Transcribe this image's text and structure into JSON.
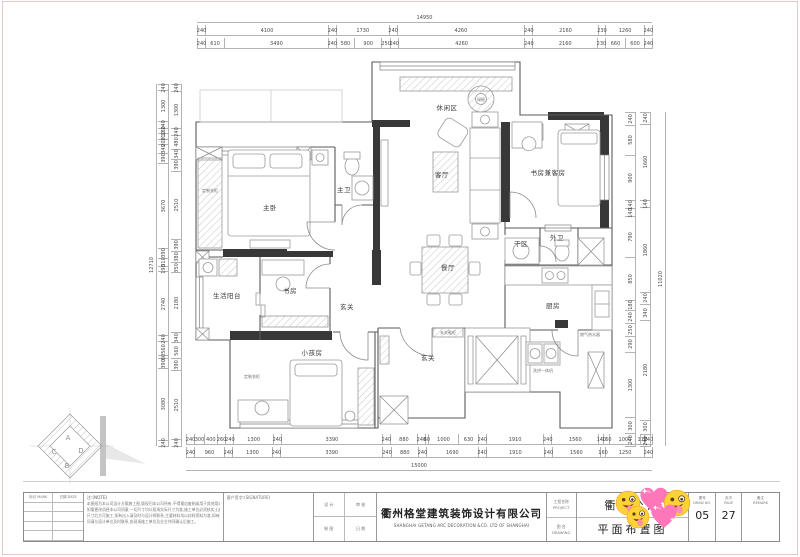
{
  "colors": {
    "wall_fill": "#383838",
    "line": "#5a5a5a",
    "dim_line": "#b3b3b3",
    "emoji_yellow": "#ffd335",
    "emoji_pink": "#ff77b9"
  },
  "stickers": [
    "zany-face",
    "sparkling-heart",
    "zany-face",
    "zany-face",
    "sparkling-heart"
  ],
  "rooms": [
    {
      "t": "休闲区",
      "x": 447,
      "y": 110
    },
    {
      "t": "客厅",
      "x": 442,
      "y": 177
    },
    {
      "t": "餐厅",
      "x": 448,
      "y": 270
    },
    {
      "t": "书房兼客房",
      "x": 548,
      "y": 175
    },
    {
      "t": "主卧",
      "x": 270,
      "y": 210
    },
    {
      "t": "主卫",
      "x": 344,
      "y": 192
    },
    {
      "t": "书房",
      "x": 290,
      "y": 293
    },
    {
      "t": "生活阳台",
      "x": 227,
      "y": 298
    },
    {
      "t": "玄关",
      "x": 347,
      "y": 309
    },
    {
      "t": "小孩房",
      "x": 312,
      "y": 355
    },
    {
      "t": "玄关",
      "x": 428,
      "y": 360
    },
    {
      "t": "厨房",
      "x": 553,
      "y": 308
    },
    {
      "t": "干区",
      "x": 521,
      "y": 246
    },
    {
      "t": "外卫",
      "x": 557,
      "y": 240
    }
  ],
  "small_labels": [
    {
      "t": "定制衣柜",
      "x": 210,
      "y": 192
    },
    {
      "t": "定制衣柜",
      "x": 252,
      "y": 378
    },
    {
      "t": "绿植",
      "x": 481,
      "y": 101
    },
    {
      "t": "玄关鞋柜",
      "x": 448,
      "y": 334
    },
    {
      "t": "燃气热水器",
      "x": 590,
      "y": 336
    },
    {
      "t": "洗烘一体机",
      "x": 543,
      "y": 372
    }
  ],
  "marker": {
    "a": "A",
    "b": "B",
    "c": "C",
    "d": "D"
  },
  "dims": {
    "top_total": "14950",
    "top2": [
      "240",
      "4100",
      "240",
      "1730",
      "240",
      "4260",
      "240",
      "2160",
      "230",
      "1260",
      "240"
    ],
    "top3": [
      "240",
      "610",
      "3490",
      "240",
      "580",
      "900",
      "250",
      "240",
      "4260",
      "240",
      "2160",
      "230",
      "660",
      "600",
      "240"
    ],
    "bottom1": [
      "240",
      "300",
      "400",
      "260",
      "240",
      "1300",
      "240",
      "3390",
      "240",
      "880",
      "240",
      "60",
      "1000",
      "630",
      "240",
      "1910",
      "240",
      "1560",
      "140",
      "160",
      "1000",
      "110",
      "240"
    ],
    "bottom2": [
      "240",
      "960",
      "240",
      "1300",
      "240",
      "3390",
      "240",
      "880",
      "240",
      "1690",
      "240",
      "1910",
      "240",
      "1560",
      "160",
      "1250",
      "240"
    ],
    "bottom_total": "15000",
    "left_total": "12710",
    "left_outer": [
      "240",
      "1300",
      "240",
      "180",
      "210",
      "200",
      "340",
      "390",
      "3670",
      "390",
      "310",
      "190",
      "2740",
      "240",
      "560",
      "80",
      "390",
      "3080",
      "240"
    ],
    "left_inner": [
      "240",
      "1300",
      "240",
      "480",
      "340",
      "390",
      "2510",
      "390",
      "380",
      "350",
      "2180",
      "340",
      "560",
      "390",
      "2510",
      "240"
    ],
    "right_inner": [
      "240",
      "580",
      "900",
      "140",
      "140",
      "790",
      "850",
      "180",
      "240",
      "250",
      "290",
      "1300",
      "300",
      "240"
    ],
    "right_outer": [
      "240",
      "1660",
      "140",
      "1860",
      "240",
      "340",
      "2180",
      "300",
      "240"
    ],
    "right_total": "11020"
  },
  "title_block": {
    "sign_headers": [
      "标记 MARK",
      "日期 DATE"
    ],
    "note_title": "注:(NOTE)",
    "notes": [
      "本图纸为本公司设计方案施工图,版权归本公司所有,不得擅自复制或用于其他用途;",
      "如需更改须经本公司同意,一切尺寸均以现场实际尺寸为准,施工单位必须核实土建",
      "尺寸后方可施工,如有出入请及时与设计师联系,主要材料均以封样资料为准,如有疑",
      "问请与设计单位及时联系,由现场施工单位及业主共同确认后施工。"
    ],
    "sig_label": "客户签字:(SIGNATURE)",
    "grid": [
      "设 计",
      "制 图",
      "审 核",
      "日 期"
    ],
    "company_cn": "衢州格堂建筑装饰设计有限公司",
    "company_en": "SHANGHAI GETANG ARC DECORATION  &CO. LTD OF SHANGHAI",
    "labels": {
      "project_cn": "工程名称",
      "project_en": "PROJECT",
      "drawing_cn": "图 名",
      "drawing_en": "DRAWING"
    },
    "project_name": "衢州公馆",
    "drawing_name": "平面布置图",
    "fig_label_cn": "图号",
    "fig_label_en": "DRAW NO.",
    "fig_no": "05",
    "page_label_cn": "页次",
    "page_label_en": "PAGE",
    "page_no": "27",
    "remark_label_cn": "备注",
    "remark_label_en": "REMARK",
    "remark": ""
  }
}
